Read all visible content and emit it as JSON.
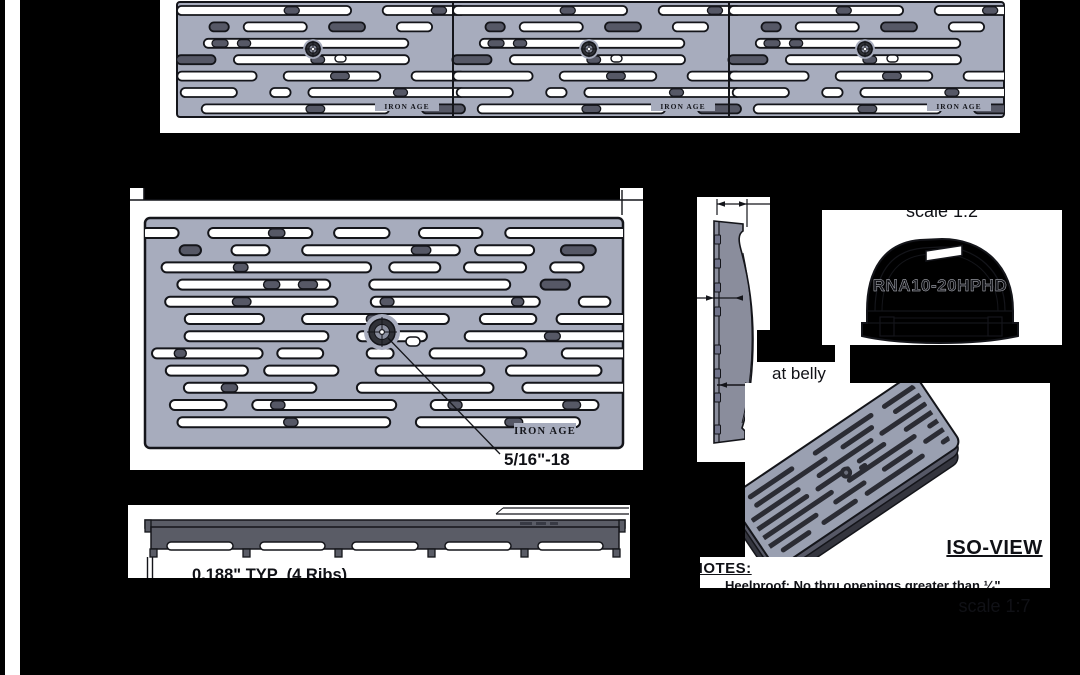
{
  "drawing": {
    "brand_label": "IRON AGE",
    "plan_view": {
      "thread_callout": "5/16\"-18"
    },
    "profile_view": {
      "inch_fragment": "\"",
      "belly_label": "at belly"
    },
    "detail_view": {
      "scale_label": "scale 1:2",
      "part_number": "RNA10-20HPHD"
    },
    "iso_view": {
      "title": "ISO-VIEW",
      "scale_label": "scale 1:7"
    },
    "side_view": {
      "rib_callout": "0.188\" TYP  (4 Ribs)"
    },
    "notes": {
      "heading": "NOTES:",
      "items": [
        "Heelproof: No thru openings greater than ¼\""
      ]
    },
    "colors": {
      "grate_fill": "#a7acbd",
      "bridge_fill": "#565866",
      "dark_part": "#5a5c66",
      "profile_fill": "#8a8d9c",
      "iso_top": "#9aa0b1",
      "iso_slot": "#2b2c34",
      "line": "#14151a"
    }
  }
}
